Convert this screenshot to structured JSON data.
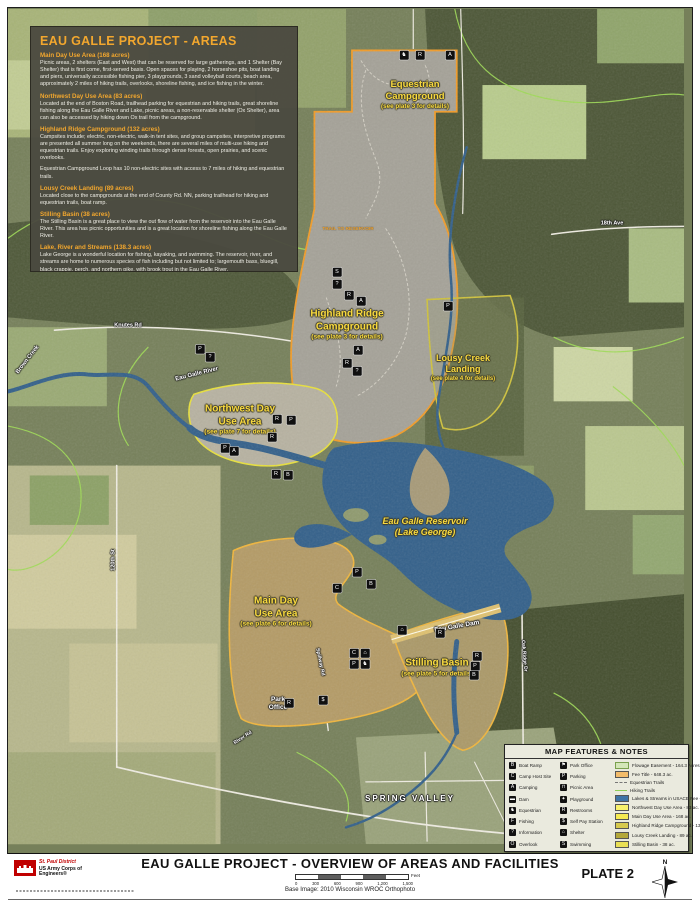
{
  "info_box": {
    "title": "EAU GALLE PROJECT - AREAS",
    "sections": [
      {
        "heading": "Main Day Use Area (168 acres)",
        "body": "Picnic areas, 2 shelters (East and West) that can be reserved for large gatherings, and 1 Shelter (Bay Shelter) that is first come, first-served basis. Open spaces for playing, 2 horseshoe pits, boat landing and piers, universally accessible fishing pier, 3 playgrounds, 3 sand volleyball courts, beach area, approximately 2 miles of hiking trails, overlooks, shoreline fishing, and ice fishing in the winter."
      },
      {
        "heading": "Northwest Day Use Area (83 acres)",
        "body": "Located at the end of Boston Road, trailhead parking for equestrian and hiking trails, great shoreline fishing along the Eau Galle River and Lake, picnic areas, a non-reservable shelter (Ox Shelter), area can also be accessed by hiking down Ox trail from the campground."
      },
      {
        "heading": "Highland Ridge Campground (132 acres)",
        "body": "Campsites include; electric, non-electric, walk-in tent sites, and group campsites, interpretive programs are presented all summer long on the weekends, there are several miles of multi-use hiking and equestrian trails.  Enjoy exploring winding trails through dense forests, open prairies, and scenic overlooks."
      },
      {
        "heading": "",
        "body": "Equestrian Campground Loop has 10 non-electric sites with access to 7 miles of hiking and equestrian trails."
      },
      {
        "heading": "Lousy Creek Landing (89 acres)",
        "body": "Located close to the campgrounds at the end of County Rd. NN, parking trailhead for hiking and equestrian trails, boat ramp."
      },
      {
        "heading": "Stilling Basin (38 acres)",
        "body": "The Stilling Basin is a great place to view the out flow of water from the reservoir into the Eau Galle River. This area has picnic opportunities and is a great location for shoreline fishing along the Eau Galle River."
      },
      {
        "heading": "Lake, River and Streams (138.3 acres)",
        "body": "Lake George is a wonderful location for fishing, kayaking, and swimming. The reservoir, river, and streams are home to numerous species of fish including but not limited to; largemouth bass, bluegill, black crappie, perch, and northern pike, with brook trout in the Eau Galle River."
      },
      {
        "heading": "",
        "body": "Due to the size and depth of the reservoir only electrically powered motors are permitted."
      }
    ]
  },
  "legend": {
    "title": "MAP FEATURES & NOTES",
    "facilities_left": [
      {
        "name": "boat-ramp",
        "glyph": "B",
        "label": "Boat Ramp"
      },
      {
        "name": "camp-host-site",
        "glyph": "C",
        "label": "Camp Host Site"
      },
      {
        "name": "camping",
        "glyph": "A",
        "label": "Camping"
      },
      {
        "name": "dam",
        "glyph": "▬",
        "label": "Dam"
      },
      {
        "name": "equestrian",
        "glyph": "♞",
        "label": "Equestrian"
      },
      {
        "name": "fishing",
        "glyph": "F",
        "label": "Fishing"
      },
      {
        "name": "information",
        "glyph": "?",
        "label": "Information"
      },
      {
        "name": "overlook",
        "glyph": "O",
        "label": "Overlook"
      }
    ],
    "facilities_right": [
      {
        "name": "park-office",
        "glyph": "⚑",
        "label": "Park Office"
      },
      {
        "name": "parking",
        "glyph": "P",
        "label": "Parking"
      },
      {
        "name": "picnic-area",
        "glyph": "⊓",
        "label": "Picnic Area"
      },
      {
        "name": "playground",
        "glyph": "✦",
        "label": "Playground"
      },
      {
        "name": "restrooms",
        "glyph": "R",
        "label": "Restrooms"
      },
      {
        "name": "self-pay-station",
        "glyph": "$",
        "label": "Self Pay Station"
      },
      {
        "name": "shelter",
        "glyph": "⌂",
        "label": "Shelter"
      },
      {
        "name": "swimming",
        "glyph": "S",
        "label": "Swimming"
      }
    ],
    "areas": [
      {
        "type": "fill",
        "color": "#d4e6b8",
        "border": "#7aa04e",
        "label": "Flowage Easement - 164.3 Acres (ac.)"
      },
      {
        "type": "fill",
        "color": "#f3bc6b",
        "label": "Fee Title - 648.3 ac."
      },
      {
        "type": "line",
        "dash": true,
        "color": "#777777",
        "label": "Equestrian Trails"
      },
      {
        "type": "line",
        "dash": false,
        "color": "#8fce58",
        "label": "Hiking Trails"
      },
      {
        "type": "fill",
        "color": "#3f74a6",
        "label": "Lakes & Streams in USACE Fee - 138.3 ac."
      },
      {
        "type": "fill",
        "color": "#f8f26d",
        "label": "Northwest Day Use Area - 83 ac."
      },
      {
        "type": "fill",
        "color": "#f5ea52",
        "label": "Main Day Use Area - 168 ac."
      },
      {
        "type": "fill",
        "color": "#d6c94e",
        "label": "Highland Ridge Campground - 132 ac."
      },
      {
        "type": "fill",
        "color": "#b4a83a",
        "label": "Lousy Creek Landing - 89 ac."
      },
      {
        "type": "fill",
        "color": "#e9df55",
        "label": "Stilling Basin - 38 ac."
      }
    ]
  },
  "map": {
    "colors": {
      "fee_boundary": "#f29c28",
      "area_boundary": "#e8e03c",
      "water": "#33608a",
      "label_yellow": "#f8d93f"
    },
    "labels": [
      {
        "name": "label-equestrian-campground",
        "lines": [
          "Equestrian",
          "Campground"
        ],
        "sub": "(see plate 3 for details)",
        "x": 415,
        "y": 95,
        "size": 9.5,
        "cls": "ylw"
      },
      {
        "name": "label-highland-ridge",
        "lines": [
          "Highland Ridge",
          "Campground"
        ],
        "sub": "(see plate 3 for details)",
        "x": 347,
        "y": 325,
        "size": 10,
        "cls": "ylw"
      },
      {
        "name": "label-lousy-creek",
        "lines": [
          "Lousy Creek",
          "Landing"
        ],
        "sub": "(see plate 4 for details)",
        "x": 463,
        "y": 368,
        "size": 9,
        "cls": "ylw"
      },
      {
        "name": "label-northwest-day-use",
        "lines": [
          "Northwest Day",
          "Use Area"
        ],
        "sub": "(see plate 7 for details)",
        "x": 240,
        "y": 420,
        "size": 10,
        "cls": "ylw"
      },
      {
        "name": "label-reservoir",
        "lines": [
          "Eau Galle Reservoir",
          "(Lake George)"
        ],
        "x": 425,
        "y": 527,
        "size": 9,
        "cls": "ylw ital"
      },
      {
        "name": "label-main-day-use",
        "lines": [
          "Main Day",
          "Use Area"
        ],
        "sub": "(see plate 6 for details)",
        "x": 276,
        "y": 612,
        "size": 10,
        "cls": "ylw"
      },
      {
        "name": "label-stilling-basin",
        "lines": [
          "Stilling Basin"
        ],
        "sub": "(see plate 5 for details)",
        "x": 437,
        "y": 668,
        "size": 10,
        "cls": "ylw"
      },
      {
        "name": "label-eau-galle-dam",
        "lines": [
          "Eau Galle Dam"
        ],
        "x": 457,
        "y": 627,
        "size": 6.5,
        "cls": "wht",
        "rot": -10
      },
      {
        "name": "label-eau-galle-river",
        "lines": [
          "Eau Galle River"
        ],
        "x": 197,
        "y": 375,
        "size": 6,
        "cls": "wht",
        "rot": -14
      },
      {
        "name": "label-knutes-rd",
        "lines": [
          "Knutes Rd"
        ],
        "x": 128,
        "y": 326,
        "size": 5.5,
        "cls": "wht"
      },
      {
        "name": "label-brown-creek",
        "lines": [
          "Brown Creek"
        ],
        "x": 28,
        "y": 360,
        "size": 5.5,
        "cls": "wht",
        "rot": -52
      },
      {
        "name": "label-spring-valley",
        "lines": [
          "SPRING VALLEY"
        ],
        "x": 410,
        "y": 799,
        "size": 8,
        "cls": "wht",
        "sp": 2
      },
      {
        "name": "label-park-office",
        "lines": [
          "Park",
          "Office"
        ],
        "x": 278,
        "y": 704,
        "size": 6.5,
        "cls": "wht"
      },
      {
        "name": "label-120th-st",
        "lines": [
          "120th St"
        ],
        "x": 114,
        "y": 560,
        "size": 5.5,
        "cls": "wht",
        "rot": -90
      },
      {
        "name": "label-18th-ave",
        "lines": [
          "18th Ave"
        ],
        "x": 612,
        "y": 224,
        "size": 5.5,
        "cls": "wht"
      },
      {
        "name": "label-spillway-rd",
        "lines": [
          "Spillway Rd"
        ],
        "x": 320,
        "y": 662,
        "size": 5,
        "cls": "wht",
        "rot": 78
      },
      {
        "name": "label-oak-ridge-dr",
        "lines": [
          "Oak Ridge Dr"
        ],
        "x": 524,
        "y": 656,
        "size": 5,
        "cls": "wht",
        "rot": 85
      },
      {
        "name": "label-river-rd",
        "lines": [
          "River Rd"
        ],
        "x": 243,
        "y": 738,
        "size": 5,
        "cls": "wht",
        "rot": -33
      },
      {
        "name": "label-trail-to-reservoir",
        "lines": [
          "TRAIL TO RESERVOIR"
        ],
        "x": 348,
        "y": 230,
        "size": 4.8,
        "cls": "org"
      }
    ],
    "icons": [
      {
        "g": "♞",
        "x": 404,
        "y": 55,
        "name": "equestrian"
      },
      {
        "g": "R",
        "x": 420,
        "y": 55,
        "name": "restrooms"
      },
      {
        "g": "A",
        "x": 450,
        "y": 55,
        "name": "camping"
      },
      {
        "g": "S",
        "x": 337,
        "y": 272,
        "name": "swimming"
      },
      {
        "g": "?",
        "x": 337,
        "y": 284,
        "name": "information"
      },
      {
        "g": "R",
        "x": 349,
        "y": 295,
        "name": "restrooms"
      },
      {
        "g": "A",
        "x": 361,
        "y": 301,
        "name": "camping"
      },
      {
        "g": "A",
        "x": 358,
        "y": 350,
        "name": "camping"
      },
      {
        "g": "R",
        "x": 347,
        "y": 363,
        "name": "restrooms"
      },
      {
        "g": "?",
        "x": 357,
        "y": 371,
        "name": "information"
      },
      {
        "g": "P",
        "x": 448,
        "y": 306,
        "name": "parking"
      },
      {
        "g": "P",
        "x": 200,
        "y": 349,
        "name": "parking"
      },
      {
        "g": "?",
        "x": 210,
        "y": 357,
        "name": "information"
      },
      {
        "g": "R",
        "x": 277,
        "y": 419,
        "name": "restrooms"
      },
      {
        "g": "P",
        "x": 291,
        "y": 420,
        "name": "parking"
      },
      {
        "g": "R",
        "x": 272,
        "y": 437,
        "name": "restrooms"
      },
      {
        "g": "P",
        "x": 225,
        "y": 448,
        "name": "parking"
      },
      {
        "g": "A",
        "x": 234,
        "y": 451,
        "name": "camping"
      },
      {
        "g": "R",
        "x": 276,
        "y": 474,
        "name": "restrooms"
      },
      {
        "g": "B",
        "x": 288,
        "y": 475,
        "name": "boat-ramp"
      },
      {
        "g": "P",
        "x": 357,
        "y": 572,
        "name": "parking"
      },
      {
        "g": "C",
        "x": 337,
        "y": 588,
        "name": "camp-host"
      },
      {
        "g": "B",
        "x": 371,
        "y": 584,
        "name": "boat-ramp"
      },
      {
        "g": "⌂",
        "x": 402,
        "y": 630,
        "name": "shelter"
      },
      {
        "g": "R",
        "x": 440,
        "y": 633,
        "name": "restrooms"
      },
      {
        "g": "C",
        "x": 354,
        "y": 653,
        "name": "camp-host"
      },
      {
        "g": "⌂",
        "x": 365,
        "y": 653,
        "name": "shelter"
      },
      {
        "g": "P",
        "x": 354,
        "y": 664,
        "name": "parking"
      },
      {
        "g": "♞",
        "x": 365,
        "y": 664,
        "name": "equestrian"
      },
      {
        "g": "R",
        "x": 289,
        "y": 703,
        "name": "restrooms"
      },
      {
        "g": "$",
        "x": 323,
        "y": 700,
        "name": "self-pay"
      },
      {
        "g": "R",
        "x": 477,
        "y": 656,
        "name": "restrooms"
      },
      {
        "g": "P",
        "x": 475,
        "y": 666,
        "name": "parking"
      },
      {
        "g": "B",
        "x": 474,
        "y": 675,
        "name": "boat-ramp"
      }
    ]
  },
  "footer": {
    "title": "EAU GALLE PROJECT - OVERVIEW OF AREAS AND FACILITIES",
    "scale_ticks": [
      "0",
      "300",
      "600",
      "900",
      "1,200",
      "1,500"
    ],
    "scale_unit": "Feet",
    "base_image": "Base Image: 2010 Wisconsin WROC Orthophoto",
    "plate": "PLATE 2",
    "north_letter": "N",
    "agency": {
      "district": "St. Paul District",
      "org": "US Army Corps of Engineers®"
    }
  }
}
